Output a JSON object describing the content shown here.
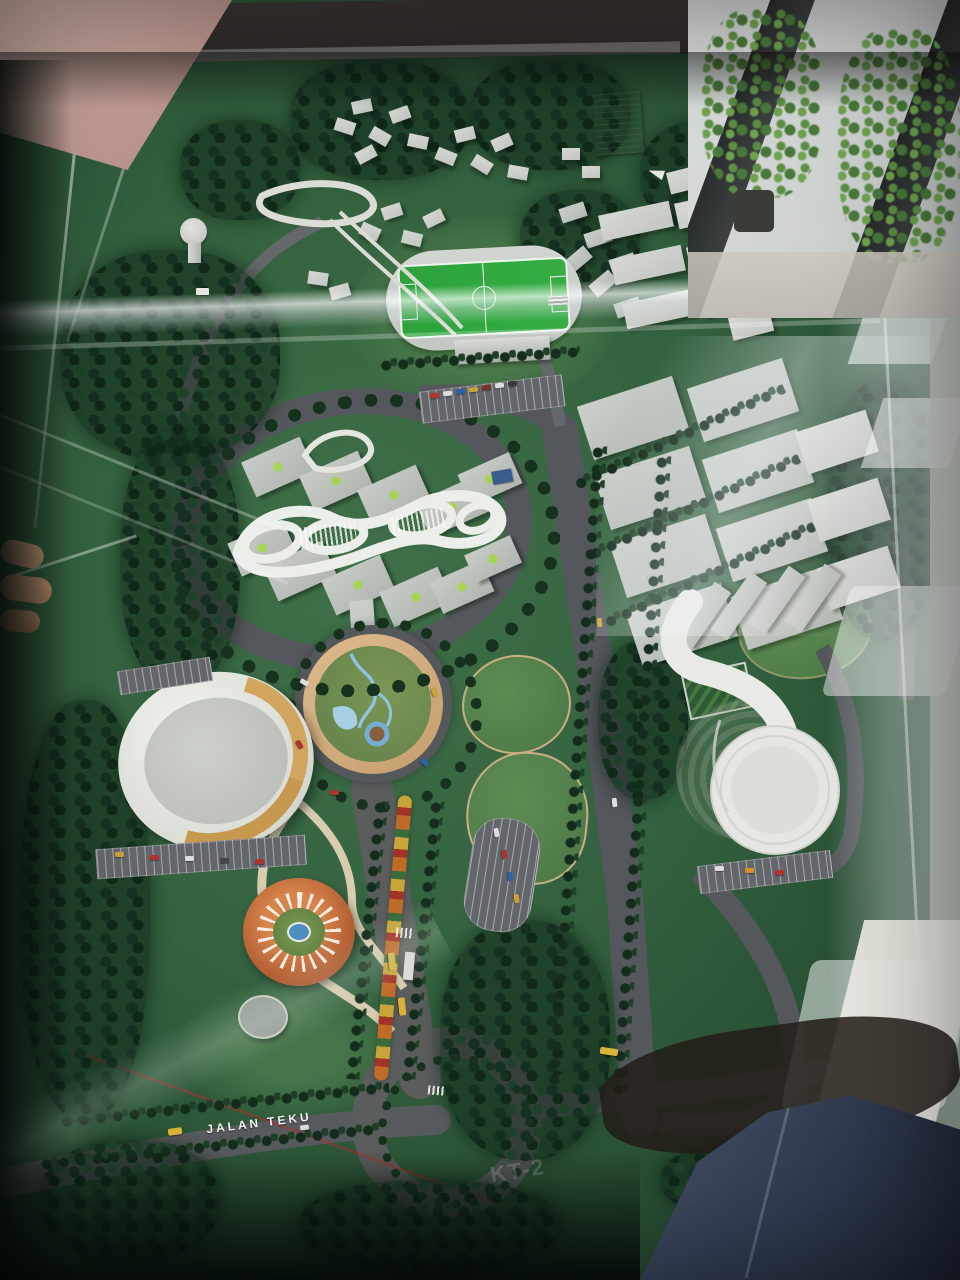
{
  "scene": {
    "subject": "Architectural scale model of a landscaped campus masterplan displayed under a clear glass case",
    "setting": "Indoor lobby: pink marble floor at top-left, window mullions with potted plants at top-right, visitor hand on case edge at left, person in jeans at lower right, window reflections on the glass",
    "labels": {
      "road_name": "JALAN TEKU",
      "pavement_mark": "KT-2"
    },
    "landmarks": [
      "water-tower",
      "residential-clusters",
      "elevated-loop-walkway",
      "information-plaque",
      "athletics-track-and-pitch",
      "grandstand",
      "industrial-grid-buildings",
      "campus-slab-buildings",
      "lattice-canopy",
      "central-map-roundabout",
      "oval-auditorium",
      "gold-louver-facade",
      "terracotta-amphitheatre",
      "helipad",
      "white-swirl-pavilion",
      "terraced-garden",
      "parterre-garden",
      "flower-median-boulevard",
      "bus-stop",
      "south-roundabout",
      "jalan-teku-road",
      "tree-lined-avenue",
      "parking-lots",
      "model-cars",
      "model-buses",
      "glass-case-reflections",
      "potted-plants",
      "visitor-hand",
      "visitor-jeans",
      "marble-floor"
    ],
    "colors": {
      "grass": "#33603e",
      "asphalt": "#54575b",
      "canopy_white": "#eceee9",
      "building_grey": "#c2c6c0",
      "running_track": "#cdd1cc",
      "pitch_green": "#2fa23d",
      "plaza_tan": "#d6b284",
      "terracotta": "#c06a3a",
      "gold_louver": "#d2a55e",
      "water_blue": "#8fc3e0",
      "flower_orange": "#c06a28",
      "bus_yellow": "#d8b23a",
      "marble": "#c7a8a0",
      "denim": "#2f3a4d",
      "foliage_dark": "#16321f"
    }
  }
}
